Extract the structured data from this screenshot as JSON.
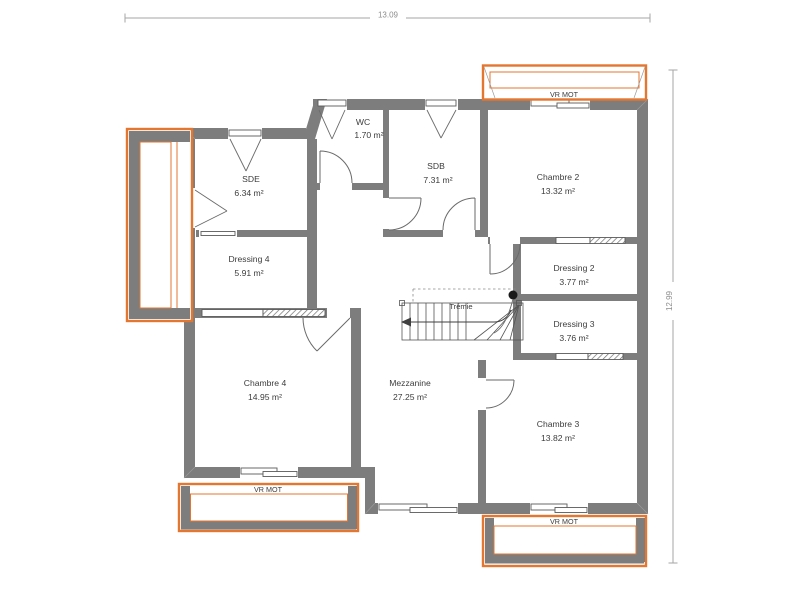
{
  "dimensions": {
    "width_label": "13.09",
    "height_label": "12.99"
  },
  "rooms": [
    {
      "name": "SDE",
      "area": "6.34 m²"
    },
    {
      "name": "WC",
      "area": "1.70 m²"
    },
    {
      "name": "SDB",
      "area": "7.31 m²"
    },
    {
      "name": "Chambre 2",
      "area": "13.32 m²"
    },
    {
      "name": "Dressing 4",
      "area": "5.91 m²"
    },
    {
      "name": "Dressing 2",
      "area": "3.77 m²"
    },
    {
      "name": "Dressing 3",
      "area": "3.76 m²"
    },
    {
      "name": "Chambre 4",
      "area": "14.95 m²"
    },
    {
      "name": "Mezzanine",
      "area": "27.25 m²"
    },
    {
      "name": "Chambre 3",
      "area": "13.82 m²"
    }
  ],
  "stair": {
    "label": "Trémie"
  },
  "shutters": {
    "top_right": "VR MOT",
    "bottom_left": "VR MOT",
    "bottom_right": "VR MOT"
  },
  "colors": {
    "wall": "#7d7d7d",
    "shutter_orange": "#e4762f",
    "text": "#3c3c3c",
    "dim_line": "#a5a5a5"
  }
}
